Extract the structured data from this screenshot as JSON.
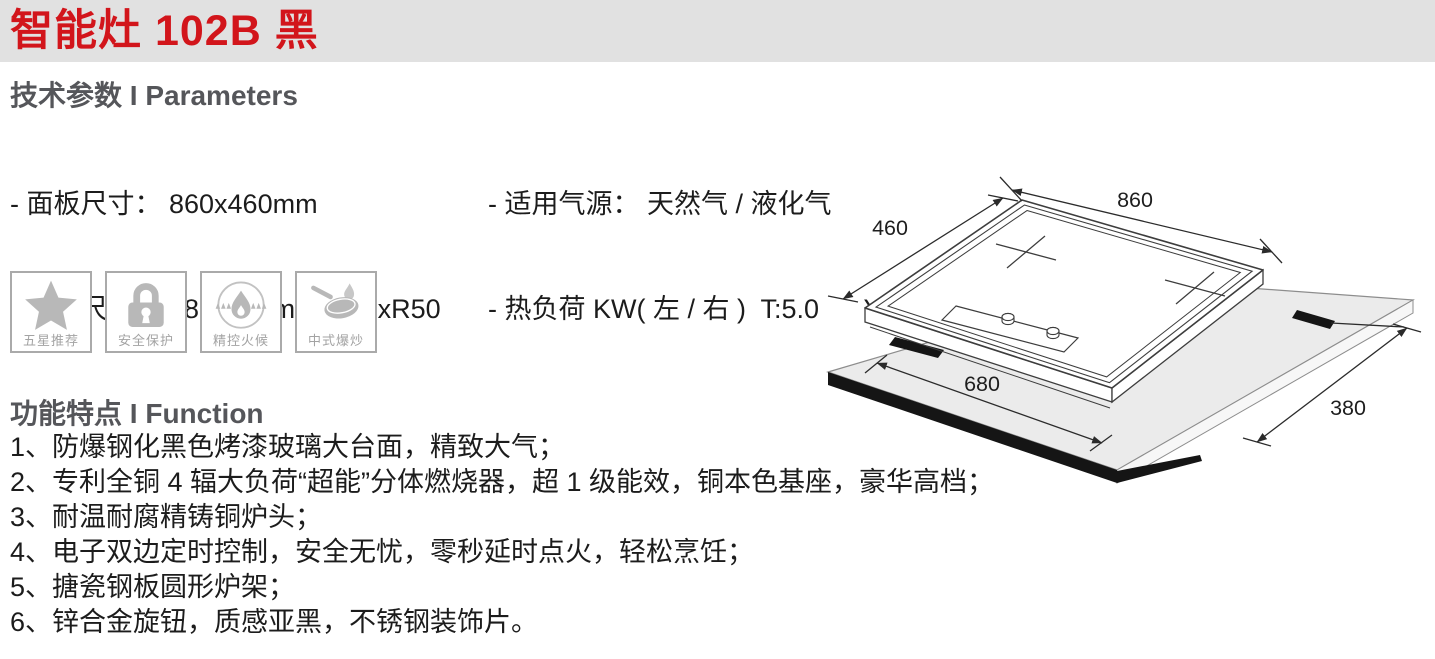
{
  "page": {
    "title": "智能灶 102B 黑"
  },
  "colors": {
    "accent_red": "#d2151b",
    "titlebar_bg": "#e1e1e1",
    "heading_gray": "#55565a"
  },
  "parameters": {
    "heading": "技术参数 I Parameters",
    "left_rows": [
      "- 面板尺寸： 860x460mm",
      "- 开孔尺寸： 680x380mm      4xR50"
    ],
    "right_rows": [
      "- 适用气源： 天然气 / 液化气",
      "- 热负荷 KW( 左 / 右 )  T:5.0      Y:5.0"
    ]
  },
  "badges": [
    {
      "icon": "star-icon",
      "label": "五星推荐"
    },
    {
      "icon": "lock-icon",
      "label": "安全保护"
    },
    {
      "icon": "flame-icon",
      "label": "精控火候"
    },
    {
      "icon": "wok-icon",
      "label": "中式爆炒"
    }
  ],
  "functions": {
    "heading": "功能特点 I Function",
    "items": [
      "1、防爆钢化黑色烤漆玻璃大台面，精致大气；",
      "2、专利全铜 4 辐大负荷“超能”分体燃烧器，超 1 级能效，铜本色基座，豪华高档；",
      "3、耐温耐腐精铸铜炉头；",
      "4、电子双边定时控制，安全无忧，零秒延时点火，轻松烹饪；",
      "5、搪瓷钢板圆形炉架；",
      "6、锌合金旋钮，质感亚黑，不锈钢装饰片。"
    ]
  },
  "diagram": {
    "panel_width": "860",
    "panel_depth": "460",
    "cutout_width": "680",
    "cutout_depth": "380"
  }
}
